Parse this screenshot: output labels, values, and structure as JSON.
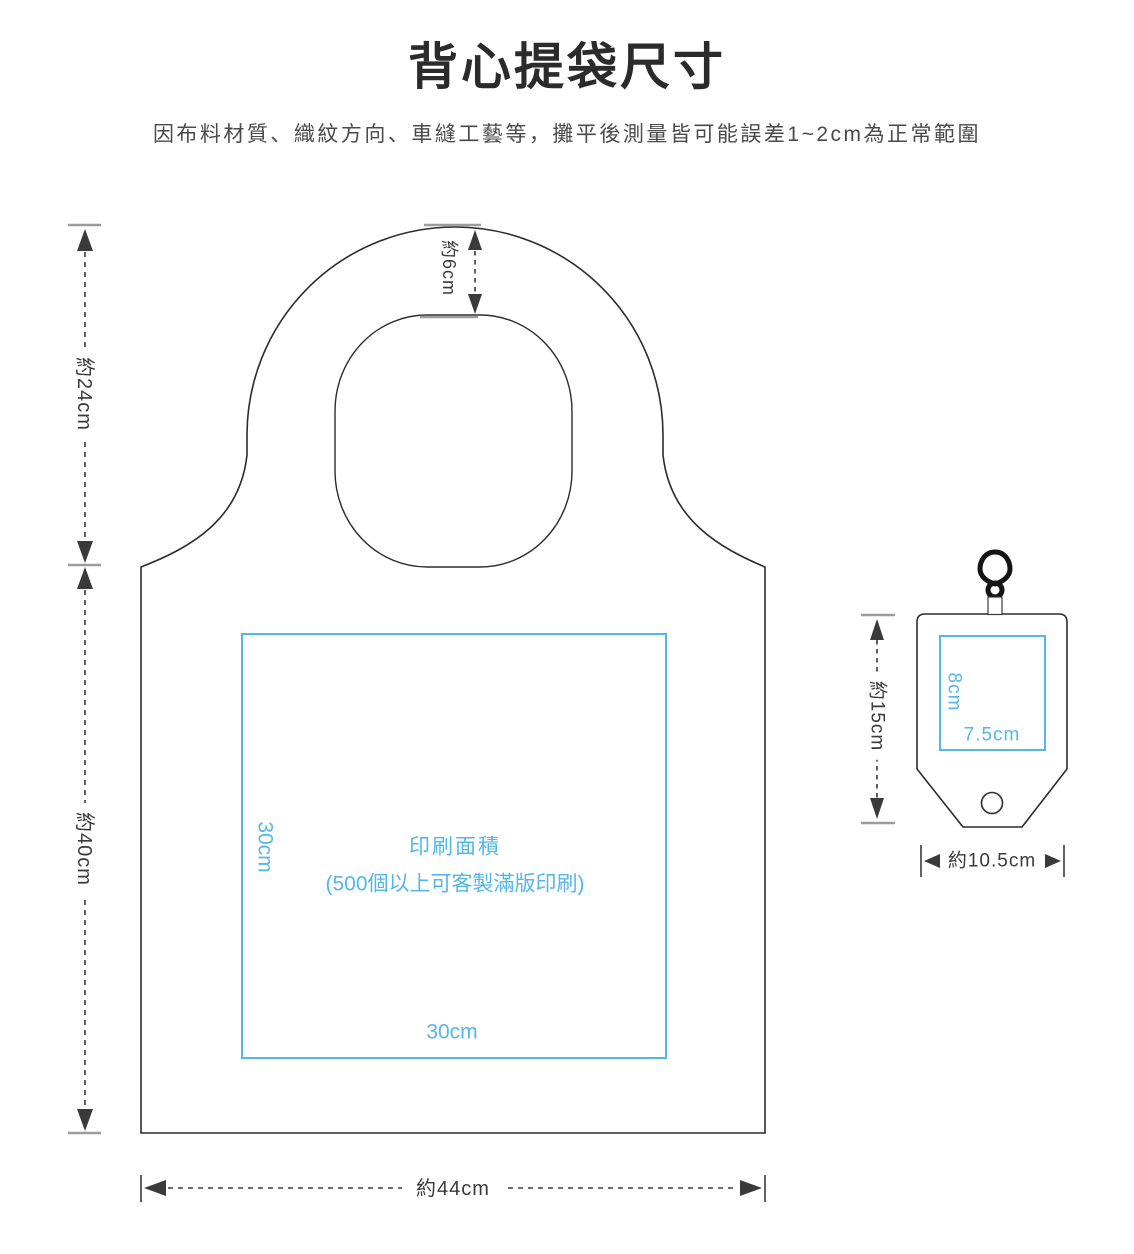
{
  "header": {
    "title": "背心提袋尺寸",
    "subtitle": "因布料材質、織紋方向、車縫工藝等，攤平後測量皆可能誤差1~2cm為正常範圍"
  },
  "colors": {
    "accent_blue": "#54b7e8",
    "line_dark": "#3a3a3a",
    "outline_dark": "#2c2c2c",
    "tick_gray": "#9c9c9c"
  },
  "bag": {
    "dims": {
      "handle": "約24cm",
      "handle_gap": "約6cm",
      "height": "約40cm",
      "width": "約44cm"
    },
    "print_area": {
      "title": "印刷面積",
      "note": "(500個以上可客製滿版印刷)",
      "height_label": "30cm",
      "width_label": "30cm"
    }
  },
  "pouch": {
    "dims": {
      "height": "約15cm",
      "width": "約10.5cm"
    },
    "print_area": {
      "height_label": "8cm",
      "width_label": "7.5cm"
    }
  }
}
